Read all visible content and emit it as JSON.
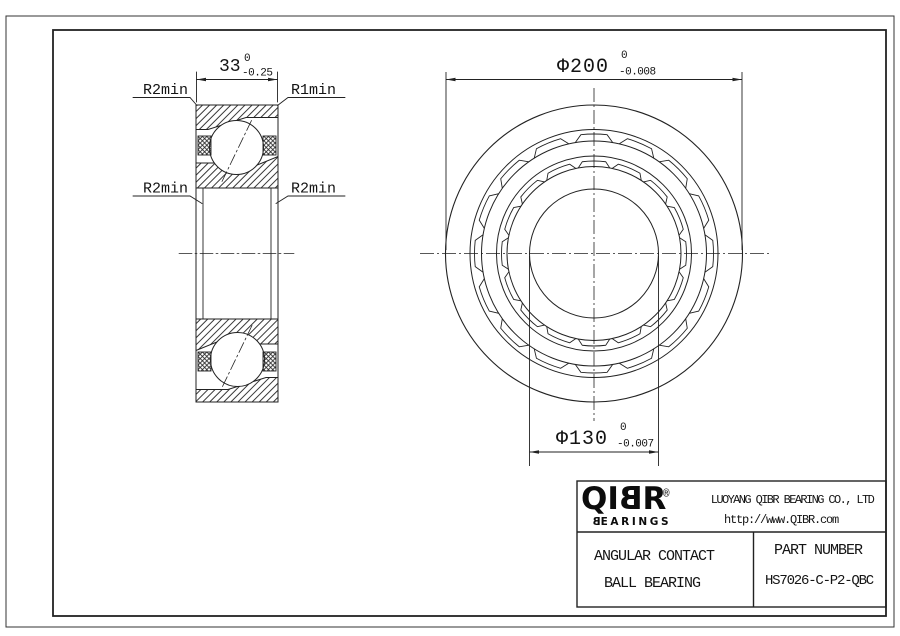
{
  "section_view": {
    "width_dim": {
      "value": "33",
      "tol_upper": "0",
      "tol_lower": "-0.25"
    },
    "labels": {
      "top_left": "R2min",
      "top_right": "R1min",
      "mid_left": "R2min",
      "mid_right": "R2min"
    }
  },
  "front_view": {
    "outer_dim": {
      "value": "Φ200",
      "tol_upper": "0",
      "tol_lower": "-0.008"
    },
    "bore_dim": {
      "value": "Φ130",
      "tol_upper": "0",
      "tol_lower": "-0.007"
    }
  },
  "title_block": {
    "logo": {
      "wordmark": "QIBR",
      "sub": "BEARINGS",
      "registered": "®"
    },
    "company": "LUOYANG QIBR BEARING CO., LTD",
    "website": "http://www.QIBR.com",
    "product_line1": "ANGULAR CONTACT",
    "product_line2": "BALL BEARING",
    "part_number_label": "PART NUMBER",
    "part_number": "HS7026-C-P2-QBC"
  }
}
